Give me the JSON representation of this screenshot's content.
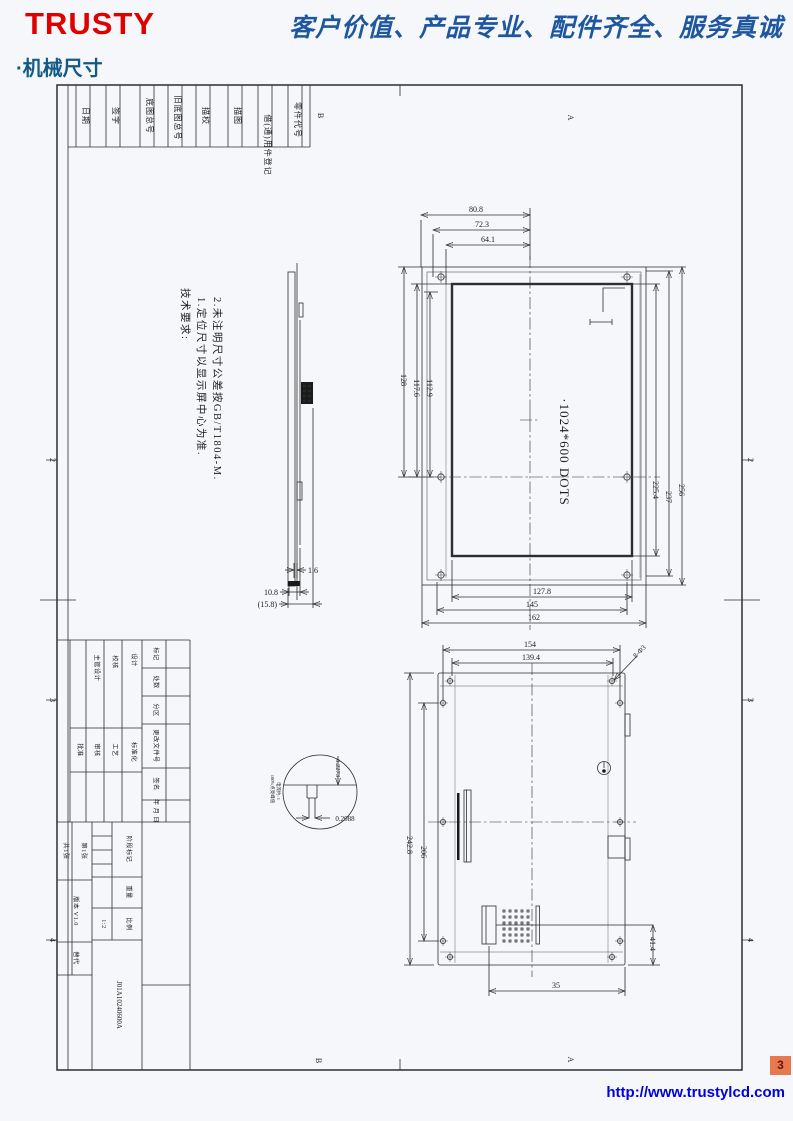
{
  "header": {
    "logo": "TRUSTY",
    "slogan": "客户价值、产品专业、配件齐全、服务真诚",
    "section_title": "·机械尺寸"
  },
  "footer": {
    "url": "http://www.trustylcd.com",
    "page_number": "3"
  },
  "sheet": {
    "zones": {
      "top_left": "B",
      "top_right": "A",
      "bottom_left": "B",
      "bottom_right": "A",
      "left": [
        "2",
        "3",
        "4"
      ],
      "right": [
        "2",
        "3",
        "4"
      ]
    },
    "top_strip": {
      "labels": [
        "日期",
        "签字",
        "底图总号",
        "旧底图总号",
        "描校",
        "描图",
        "借(通)用件登记",
        "零件代号"
      ]
    },
    "notes": {
      "title": "技术要求:",
      "line1": "1.定位尺寸以显示屏中心为准.",
      "line2": "2.未注明尺寸公差按GB/T1804-M."
    },
    "title_block": {
      "roles_top": [
        "主管设计",
        "校核",
        "设计"
      ],
      "roles_bottom": [
        "批准",
        "审核",
        "工艺",
        "标准化"
      ],
      "revision_labels": [
        "标记",
        "处数",
        "分区",
        "更改文件号",
        "签名",
        "年 月 日"
      ],
      "sheet_total": "共1张",
      "sheet_no": "第1张",
      "version": "版本 V1.0",
      "replace": "替代",
      "stage_label": "阶段标记",
      "weight_label": "重量",
      "scale_label": "比例",
      "scale_value": "1:2",
      "part_number": "J01A10240600A"
    },
    "front_view": {
      "dots": "·1024*600 DOTS",
      "dims_top": [
        "80.8",
        "72.3",
        "64.1"
      ],
      "dims_left": [
        "112.9",
        "117.6",
        "128"
      ],
      "dims_right": [
        "225.4",
        "237",
        "256"
      ],
      "dims_bottom": [
        "127.8",
        "145",
        "162"
      ]
    },
    "side_view": {
      "dims": [
        "1.6",
        "10.8",
        "(15.8)"
      ]
    },
    "rear_view": {
      "dims_top": [
        "154",
        "139.4"
      ],
      "hole_note": "8-Ф3",
      "dims_left": [
        "242.8",
        "206"
      ],
      "dim_right": "41.4",
      "dim_bottom": "35",
      "detail": {
        "dim_v": "0.2273",
        "dim_h": "0.2088",
        "note1": "100%点亮峰值",
        "note2": "电流约: 1"
      }
    }
  }
}
